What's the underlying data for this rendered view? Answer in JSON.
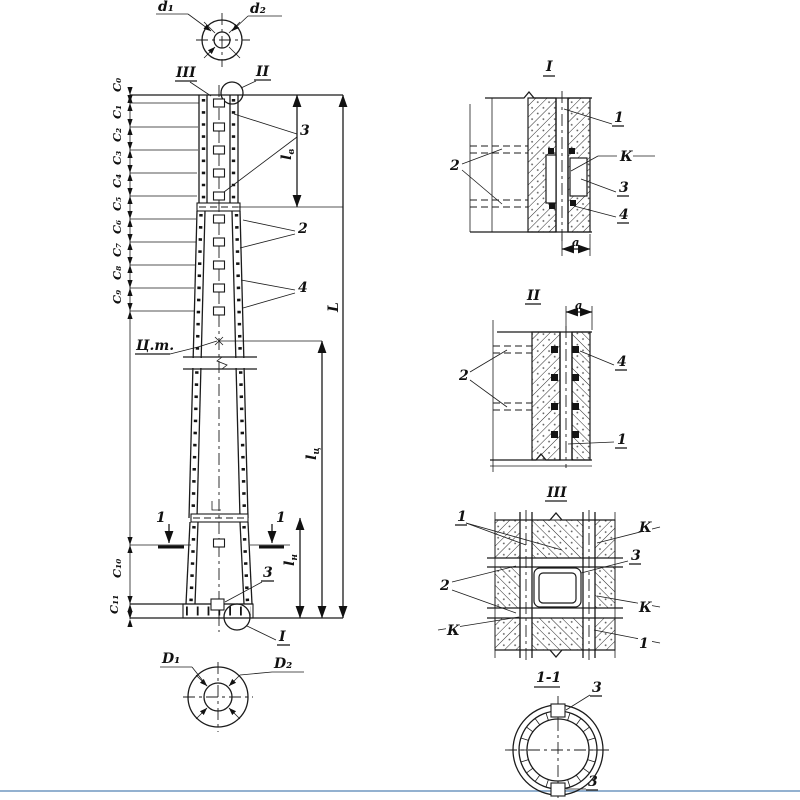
{
  "page": {
    "background": "#ffffff",
    "accent_line_color": "#93b1d0"
  },
  "labels": {
    "top_plan": {
      "d1": "d₁",
      "d2": "d₂"
    },
    "bottom_plan": {
      "D1": "D₁",
      "D2": "D₂"
    },
    "marks": {
      "m1": "I",
      "m2": "II",
      "m3": "III",
      "s11": "1-1"
    },
    "parts": {
      "p1": "1",
      "p2": "2",
      "p3": "3",
      "p4": "4",
      "k": "К"
    },
    "elevation": {
      "cg": "Ц.т.",
      "cut": "1",
      "c": [
        "C₀",
        "C₁",
        "C₂",
        "C₃",
        "C₄",
        "C₅",
        "C₆",
        "C₇",
        "C₈",
        "C₉",
        "C₁₀",
        "C₁₁"
      ]
    },
    "dims": {
      "L": "L",
      "a": "a",
      "l_base": "l",
      "sub_top": "в",
      "sub_cg": "ц",
      "sub_bottom": "н"
    }
  }
}
